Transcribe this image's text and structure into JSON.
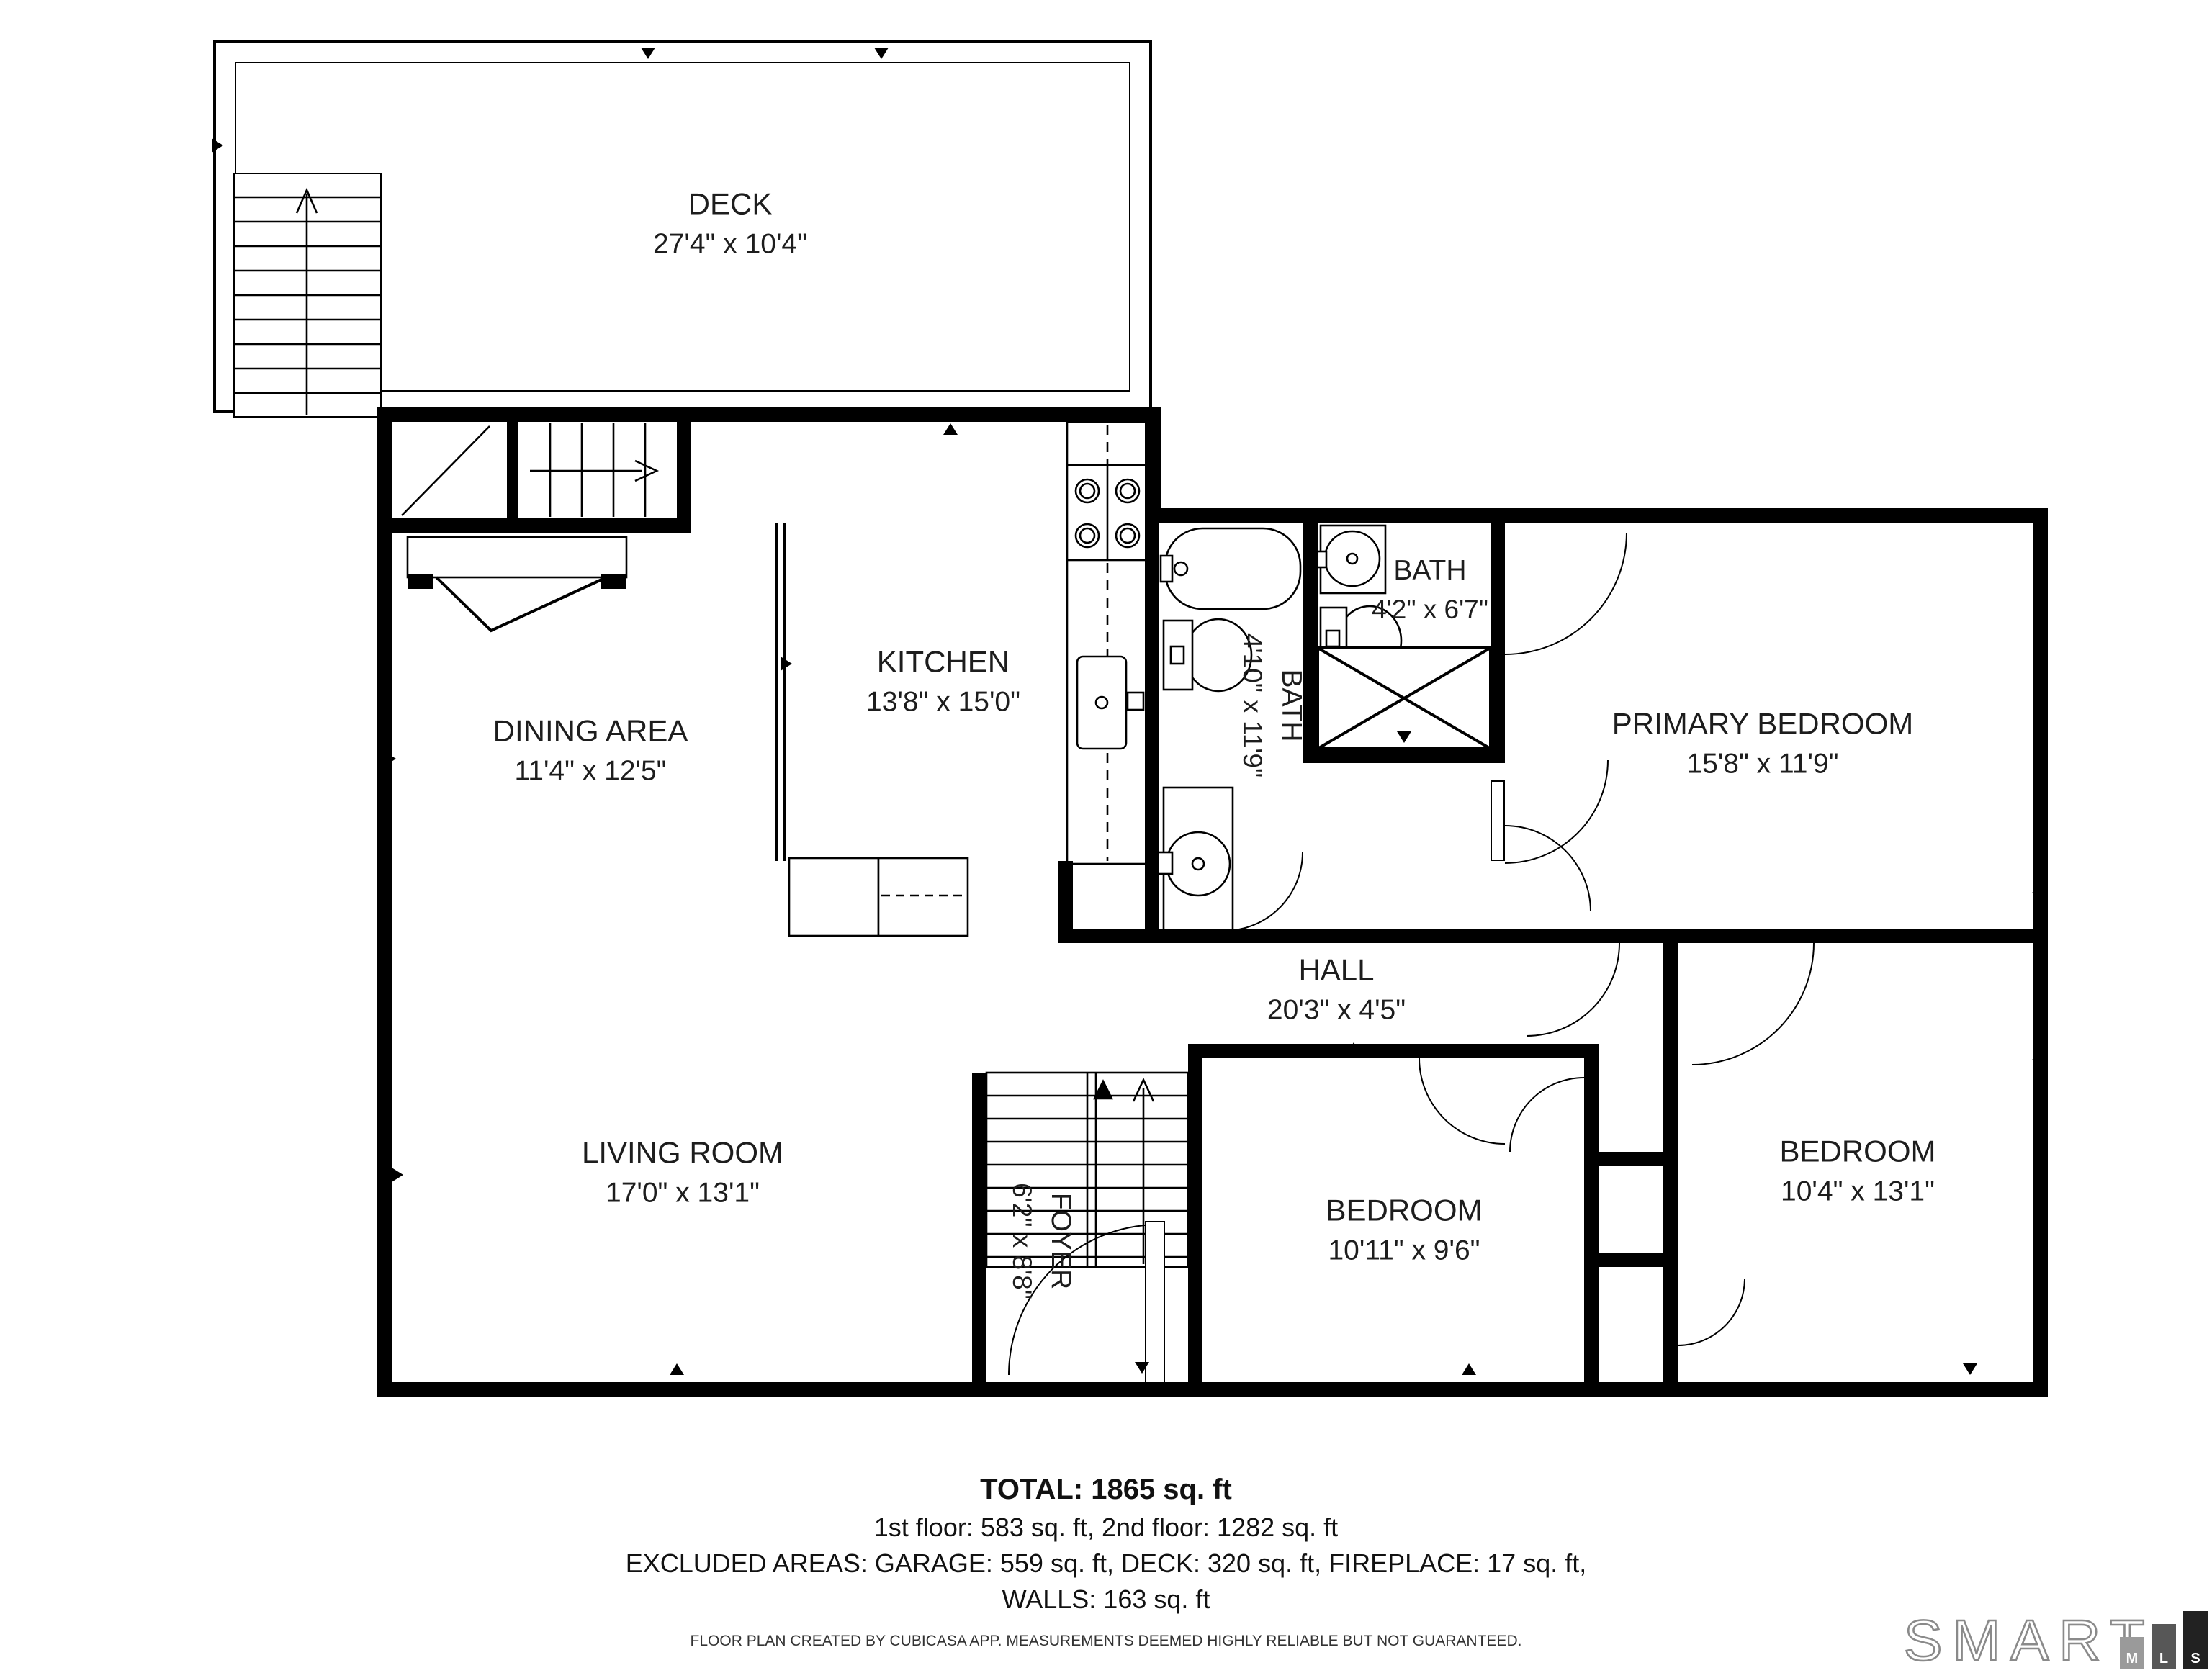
{
  "plan": {
    "rooms": [
      {
        "name": "DECK",
        "dims": "27'4\" x 10'4\""
      },
      {
        "name": "DINING AREA",
        "dims": "11'4\" x 12'5\""
      },
      {
        "name": "KITCHEN",
        "dims": "13'8\" x 15'0\""
      },
      {
        "name": "BATH",
        "dims": "4'10\" x 11'9\""
      },
      {
        "name": "BATH",
        "dims": "4'2\" x 6'7\""
      },
      {
        "name": "PRIMARY BEDROOM",
        "dims": "15'8\" x 11'9\""
      },
      {
        "name": "HALL",
        "dims": "20'3\" x 4'5\""
      },
      {
        "name": "LIVING ROOM",
        "dims": "17'0\" x 13'1\""
      },
      {
        "name": "FOYER",
        "dims": "6'2\" x 8'8\""
      },
      {
        "name": "BEDROOM",
        "dims": "10'11\" x 9'6\""
      },
      {
        "name": "BEDROOM",
        "dims": "10'4\" x 13'1\""
      }
    ],
    "summary": {
      "total": "TOTAL: 1865 sq. ft",
      "floors": "1st floor: 583 sq. ft, 2nd floor: 1282 sq. ft",
      "excluded": "EXCLUDED AREAS: GARAGE: 559 sq. ft, DECK: 320 sq. ft, FIREPLACE: 17 sq. ft,",
      "walls": "WALLS: 163 sq. ft"
    },
    "disclaimer": "FLOOR PLAN CREATED BY CUBICASA APP. MEASUREMENTS DEEMED HIGHLY RELIABLE BUT NOT GUARANTEED.",
    "logo": {
      "brand": "SMART",
      "letters": [
        "M",
        "L",
        "S"
      ]
    }
  }
}
